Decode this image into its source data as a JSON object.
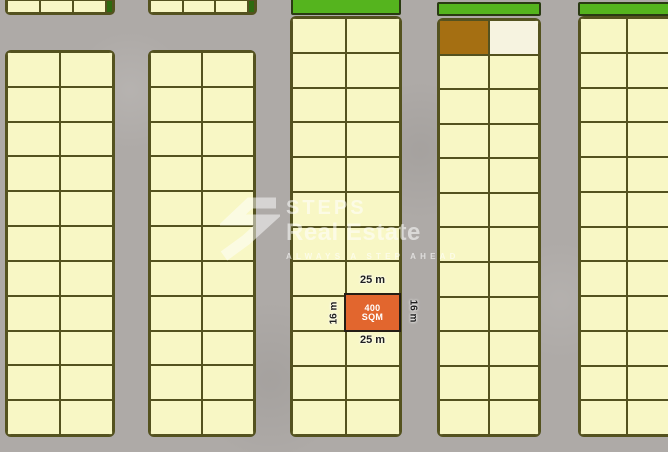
{
  "title": "Residential land plot map",
  "watermark": {
    "logo_icon": "steps-zigzag-s-icon",
    "brand_top": "STEPS",
    "brand_bottom": "Real Estate",
    "tagline": "ALWAYS A STEP AHEAD"
  },
  "highlight_plot": {
    "area_line1": "400",
    "area_line2": "SQM",
    "dim_top": "25 m",
    "dim_bottom": "25 m",
    "dim_left": "16 m",
    "dim_right": "16 m"
  },
  "colors": {
    "road": "#aeaaa7",
    "plot_fill": "#f8f7c5",
    "plot_border": "#54521f",
    "green_strip": "#55b41e",
    "brown_plot": "#a56f12",
    "highlight": "#e2662e",
    "highlight_border": "#241d15",
    "dim_text": "#1f1f1f",
    "watermark": "#ffffff"
  },
  "map": {
    "blocks": [
      {
        "id": "block-1-top",
        "x": 5,
        "y": 0,
        "w": 110,
        "h": 15,
        "rows": 1,
        "cols": 3,
        "variant": "top-partial",
        "green_sliver": true
      },
      {
        "id": "block-2-top",
        "x": 148,
        "y": 0,
        "w": 109,
        "h": 15,
        "rows": 1,
        "cols": 3,
        "variant": "top-partial",
        "green_sliver": true
      },
      {
        "id": "block-1",
        "x": 5,
        "y": 50,
        "w": 110,
        "h": 387,
        "rows": 11,
        "cols": 2
      },
      {
        "id": "block-2",
        "x": 148,
        "y": 50,
        "w": 108,
        "h": 387,
        "rows": 11,
        "cols": 2
      },
      {
        "id": "block-3",
        "x": 290,
        "y": 16,
        "w": 112,
        "h": 421,
        "rows": 12,
        "cols": 2
      },
      {
        "id": "block-4",
        "x": 437,
        "y": 18,
        "w": 104,
        "h": 419,
        "rows": 12,
        "cols": 2,
        "brown_cells": [
          [
            0,
            0
          ]
        ],
        "cream_cells": [
          [
            0,
            1
          ]
        ]
      },
      {
        "id": "block-5",
        "x": 578,
        "y": 16,
        "w": 96,
        "h": 421,
        "rows": 12,
        "cols": 2,
        "variant": "clip-right"
      }
    ],
    "green_strips": [
      {
        "id": "green-strip-1",
        "x": 291,
        "y": -3,
        "w": 110,
        "h": 18
      },
      {
        "id": "green-strip-2",
        "x": 437,
        "y": 2,
        "w": 104,
        "h": 14
      },
      {
        "id": "green-strip-3",
        "x": 578,
        "y": 2,
        "w": 96,
        "h": 14
      }
    ],
    "highlight_rect": {
      "x": 344,
      "y": 293,
      "w": 57,
      "h": 39
    }
  }
}
